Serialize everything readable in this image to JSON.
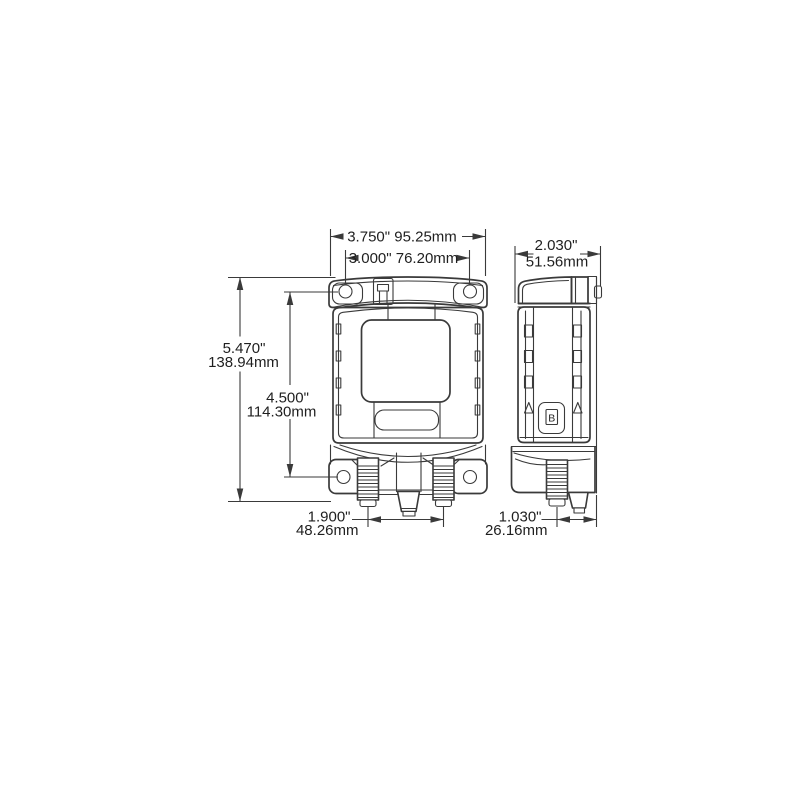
{
  "dimensions": {
    "front_overall_width": "3.750\" 95.25mm",
    "front_hole_spacing_h": "3.000\" 76.20mm",
    "front_overall_height_in": "5.470\"",
    "front_overall_height_mm": "138.94mm",
    "front_hole_spacing_v_in": "4.500\"",
    "front_hole_spacing_v_mm": "114.30mm",
    "front_stud_spacing_in": "1.900\"",
    "front_stud_spacing_mm": "48.26mm",
    "side_depth_in": "2.030\"",
    "side_depth_mm": "51.56mm",
    "side_stud_offset_in": "1.030\"",
    "side_stud_offset_mm": "26.16mm"
  },
  "side_view": {
    "marking": "B"
  },
  "colors": {
    "background": "#ffffff",
    "line": "#3a3a3a",
    "text": "#1f1f1f"
  }
}
